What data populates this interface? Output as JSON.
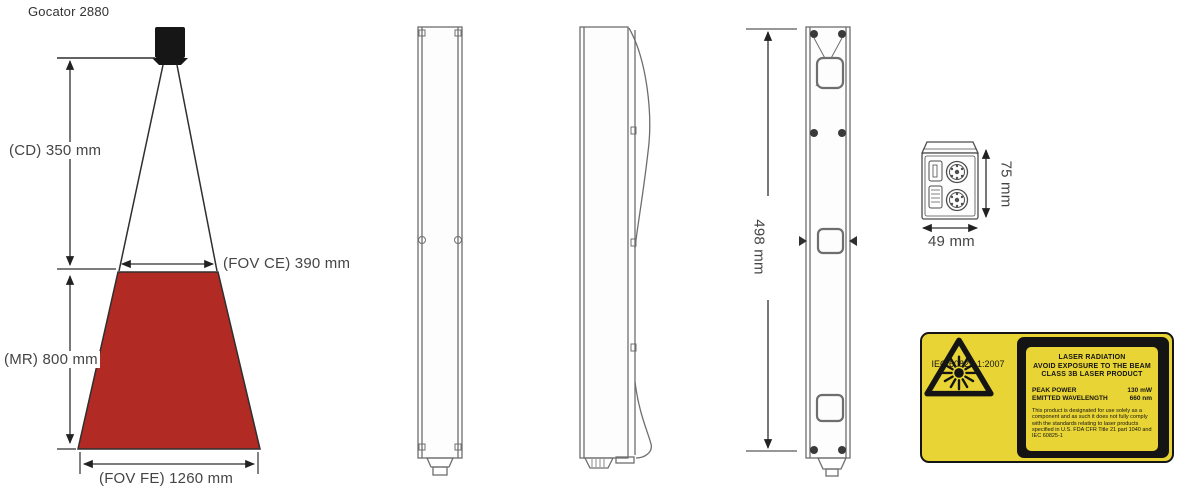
{
  "title": "Gocator 2880",
  "fov": {
    "cd": "(CD) 350 mm",
    "fov_ce": "(FOV CE) 390 mm",
    "mr": "(MR) 800 mm",
    "fov_fe": "(FOV FE) 1260 mm"
  },
  "dims": {
    "height": "498 mm",
    "depth": "75 mm",
    "width": "49 mm"
  },
  "laser_label": {
    "iec_standard": "IEC 60825-1:2007",
    "warning_lines": [
      "LASER RADIATION",
      "AVOID EXPOSURE TO THE BEAM",
      "CLASS 3B LASER PRODUCT"
    ],
    "specs": [
      {
        "name": "PEAK POWER",
        "value": "130 mW"
      },
      {
        "name": "EMITTED WAVELENGTH",
        "value": "660 nm"
      }
    ],
    "disclaimer": "This product is designated for use solely as a component and as such it does not fully comply with the standards relating to laser products specified in U.S. FDA CFR Title 21 part 1040 and IEC 60825-1"
  },
  "icons": {
    "laser_warning": "laser-starburst-warning-triangle"
  },
  "colors": {
    "fov_fill": "#B12B24",
    "label_yellow": "#E8D434",
    "label_black": "#141414",
    "drawing_line": "#2f2f2f",
    "body_line": "#6e6e6e",
    "dim_text": "#454545"
  }
}
